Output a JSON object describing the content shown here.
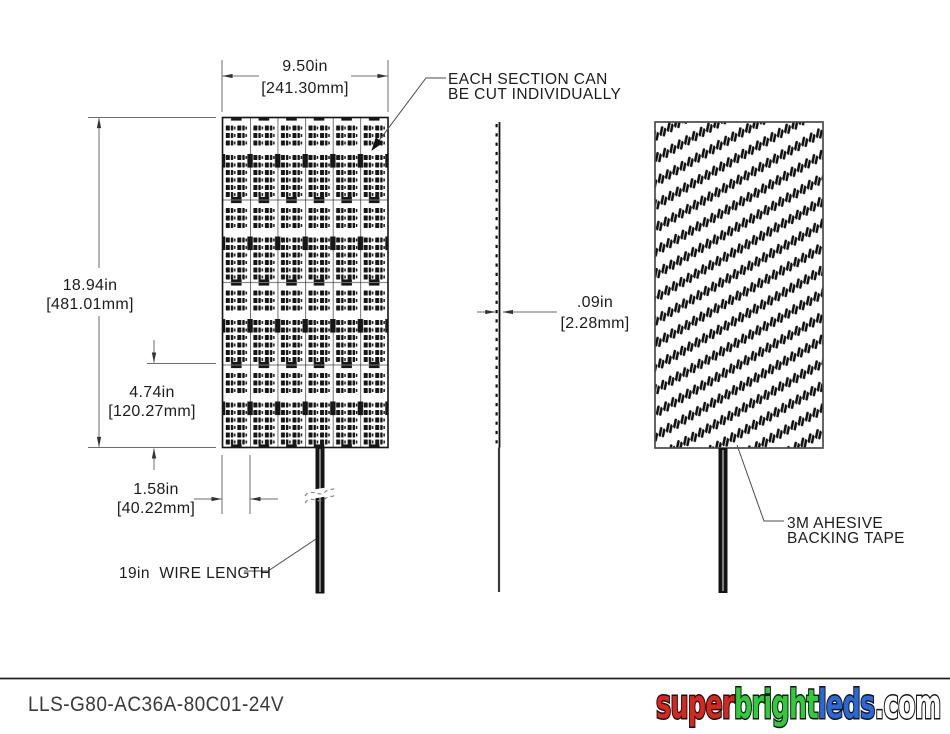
{
  "drawing": {
    "dimensions": {
      "width_in": "9.50in",
      "width_mm": "[241.30mm]",
      "height_in": "18.94in",
      "height_mm": "[481.01mm]",
      "section_height_in": "4.74in",
      "section_height_mm": "[120.27mm]",
      "section_width_in": "1.58in",
      "section_width_mm": "[40.22mm]",
      "thickness_in": ".09in",
      "thickness_mm": "[2.28mm]",
      "wire_length_label": "19in  WIRE LENGTH"
    },
    "callouts": {
      "cut_note_line1": "EACH SECTION CAN",
      "cut_note_line2": "BE CUT INDIVIDUALLY",
      "tape_note_line1": "3M AHESIVE",
      "tape_note_line2": "BACKING TAPE"
    }
  },
  "title_block": {
    "part_number": "LLS-G80-AC36A-80C01-24V"
  },
  "logo": {
    "segments": [
      {
        "text": "super",
        "color": "#da251c"
      },
      {
        "text": "bright",
        "color": "#2ecc38"
      },
      {
        "text": "leds",
        "color": "#2a67d9"
      },
      {
        "text": ".com",
        "color": "#ffffff"
      }
    ]
  }
}
